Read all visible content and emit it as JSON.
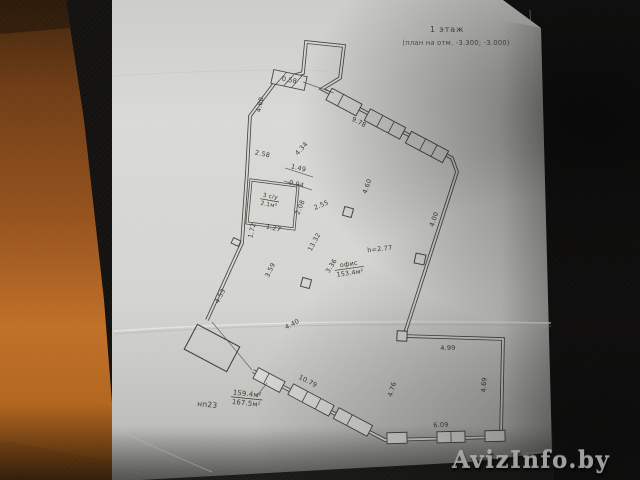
{
  "scene": {
    "colors": {
      "bg": "#131211",
      "wood": "#a2591f",
      "paper": "#d6d6d2",
      "ink": "#45443f"
    }
  },
  "title": {
    "line1": "1 этаж",
    "line2": "(план на отм. -3.300; -3.000)"
  },
  "watermark": {
    "text": "AvizInfo.by"
  },
  "plan": {
    "height_note": "h=2.77",
    "dimensions": [
      {
        "text": "4.60",
        "x": 262,
        "y": 105,
        "rot": -78
      },
      {
        "text": "2.58",
        "x": 262,
        "y": 156,
        "rot": 12
      },
      {
        "text": "1.49",
        "x": 298,
        "y": 170,
        "rot": 14
      },
      {
        "text": "0.94",
        "x": 296,
        "y": 186,
        "rot": 14
      },
      {
        "text": "2.08",
        "x": 302,
        "y": 208,
        "rot": -68
      },
      {
        "text": "1.27",
        "x": 273,
        "y": 230,
        "rot": 14
      },
      {
        "text": "1.72",
        "x": 254,
        "y": 231,
        "rot": -76
      },
      {
        "text": "4.53",
        "x": 222,
        "y": 297,
        "rot": -63
      },
      {
        "text": "3.59",
        "x": 272,
        "y": 271,
        "rot": -64
      },
      {
        "text": "4.34",
        "x": 303,
        "y": 150,
        "rot": -48
      },
      {
        "text": "2.55",
        "x": 322,
        "y": 207,
        "rot": -22
      },
      {
        "text": "4.60",
        "x": 369,
        "y": 187,
        "rot": -70
      },
      {
        "text": "13.32",
        "x": 316,
        "y": 243,
        "rot": -62
      },
      {
        "text": "3.36",
        "x": 333,
        "y": 267,
        "rot": -58
      },
      {
        "text": "9.78",
        "x": 358,
        "y": 124,
        "rot": 27
      },
      {
        "text": "0.58",
        "x": 289,
        "y": 82,
        "rot": 10,
        "size": 5.5
      },
      {
        "text": "4.00",
        "x": 436,
        "y": 220,
        "rot": -71
      },
      {
        "text": "h=2.77",
        "x": 380,
        "y": 251,
        "rot": -6
      },
      {
        "text": "4.40",
        "x": 293,
        "y": 326,
        "rot": -27
      },
      {
        "text": "10.79",
        "x": 307,
        "y": 383,
        "rot": 27
      },
      {
        "text": "4.99",
        "x": 448,
        "y": 350,
        "rot": -2
      },
      {
        "text": "4.69",
        "x": 486,
        "y": 385,
        "rot": -86
      },
      {
        "text": "4.76",
        "x": 394,
        "y": 390,
        "rot": -73
      },
      {
        "text": "6.09",
        "x": 441,
        "y": 427,
        "rot": -2
      }
    ],
    "labels": [
      {
        "name": "office-area-label",
        "x": 349,
        "y": 266,
        "rot": -8,
        "size": 6.4,
        "underline": 0,
        "lines": [
          "офис",
          "153.4м²"
        ]
      },
      {
        "name": "bathroom-label",
        "x": 270,
        "y": 198,
        "rot": 10,
        "size": 5.8,
        "underline": 0,
        "lines": [
          "3 с/у",
          "2.1м²"
        ]
      },
      {
        "name": "unit-area-fraction",
        "x": 247,
        "y": 396,
        "rot": 6,
        "size": 6.8,
        "underline": 0,
        "lines": [
          "159.4м²",
          "167.5м²"
        ]
      },
      {
        "name": "unit-number",
        "x": 207,
        "y": 407,
        "rot": 6,
        "size": 7.5,
        "underline": -1,
        "lines": [
          "нп23"
        ]
      }
    ]
  }
}
